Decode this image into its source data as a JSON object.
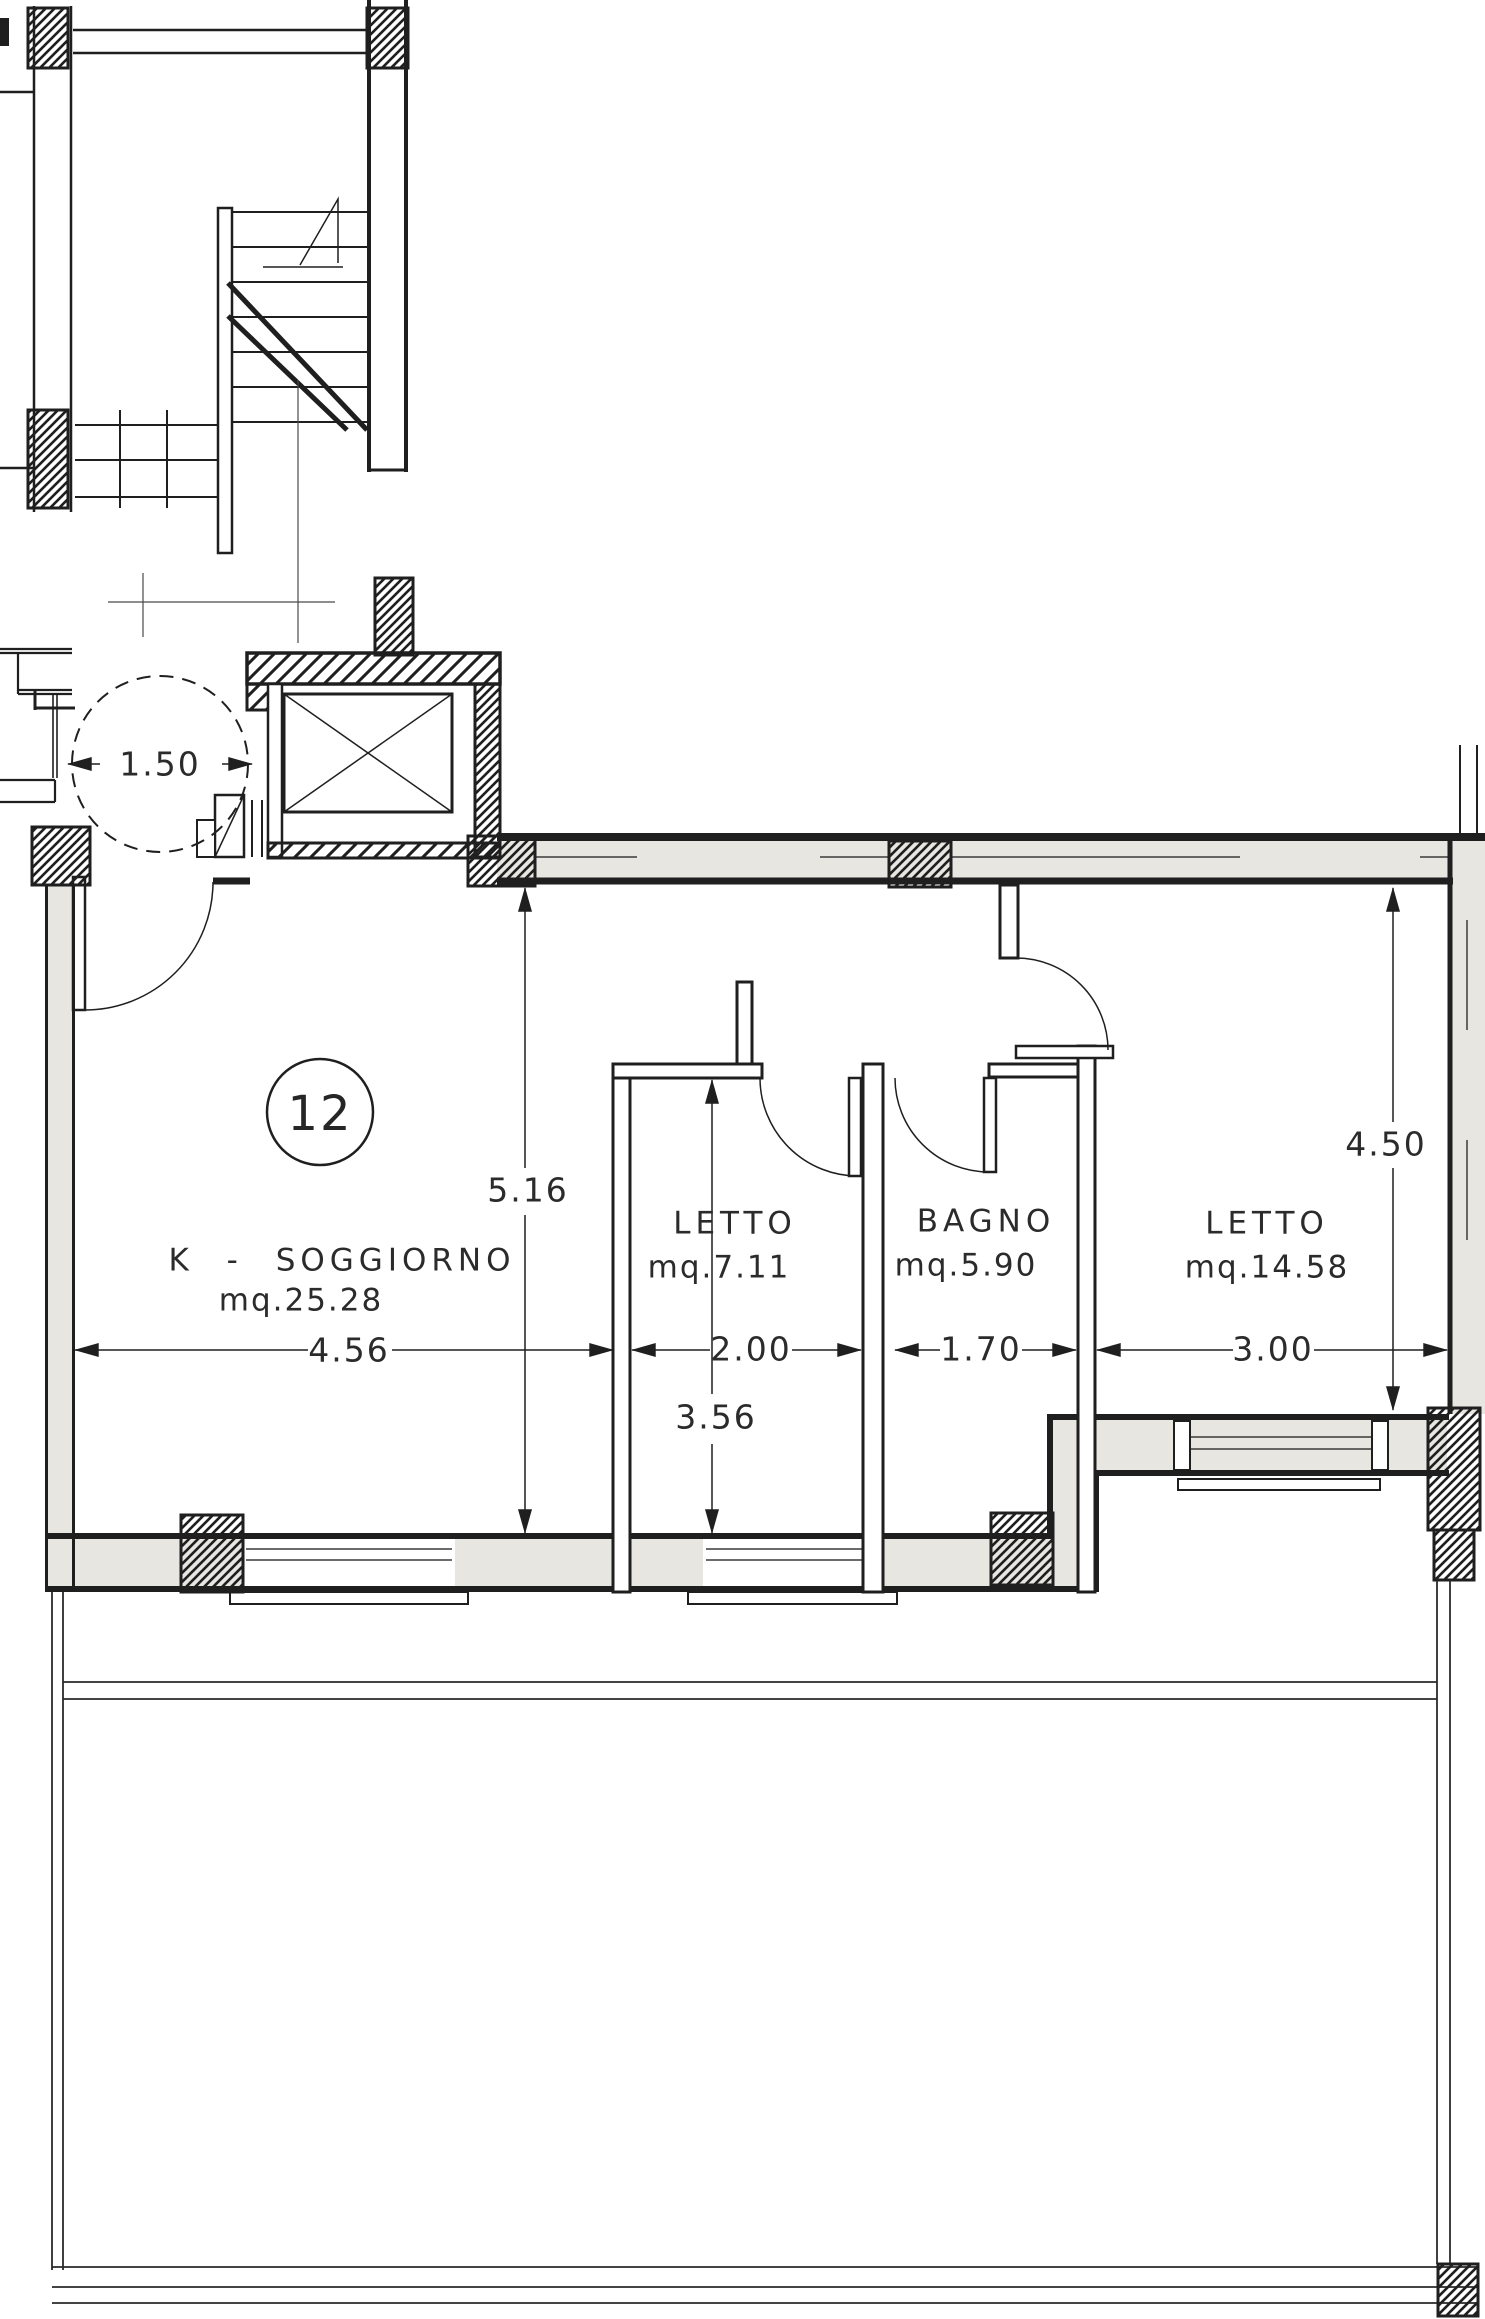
{
  "drawing": {
    "apartment_number": "12",
    "rooms": [
      {
        "name": "K - SOGGIORNO",
        "area": "mq.25.28"
      },
      {
        "name": "LETTO",
        "area": "mq.7.11"
      },
      {
        "name": "BAGNO",
        "area": "mq.5.90"
      },
      {
        "name": "LETTO",
        "area": "mq.14.58"
      }
    ],
    "dims": {
      "turning_circle": "1.50",
      "soggiorno_width": "4.56",
      "soggiorno_height": "5.16",
      "letto1_width": "2.00",
      "letto1_height": "3.56",
      "bagno_width": "1.70",
      "letto2_width": "3.00",
      "letto2_height": "4.50"
    },
    "colors": {
      "line": "#1f1f1f",
      "thin_line": "#3a3a3a",
      "wall_fill": "#e8e6e0",
      "paper": "#ffffff"
    }
  }
}
